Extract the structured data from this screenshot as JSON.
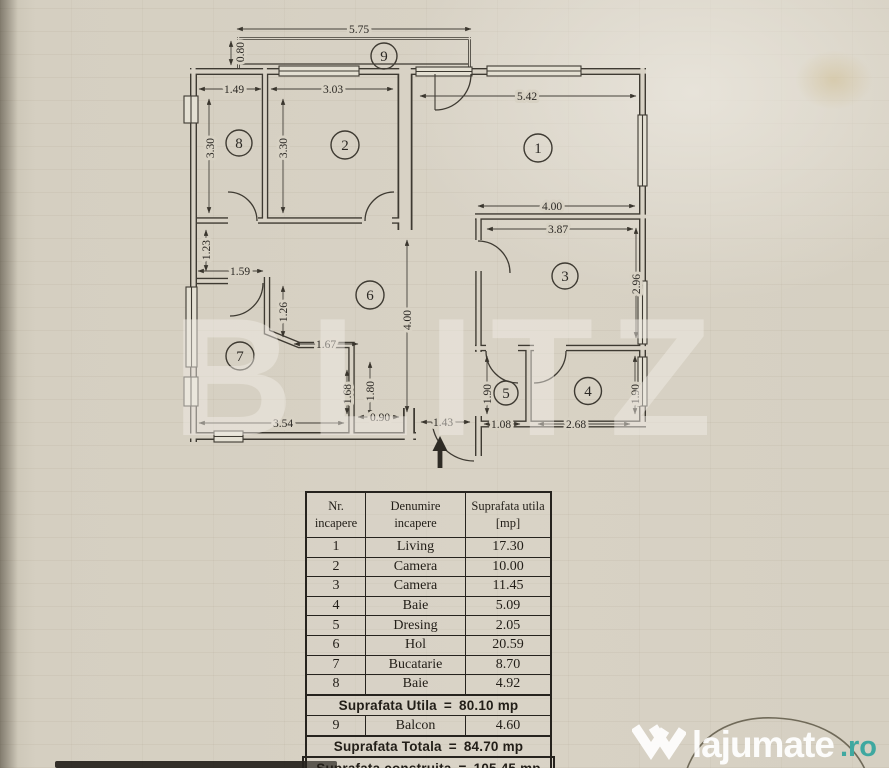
{
  "paper": {
    "color": "#d7d1c3"
  },
  "watermark": {
    "text": "BLITZ"
  },
  "brand": {
    "name": "lajumate",
    "tld": ".ro",
    "icon": "double-chevron-w-icon"
  },
  "floorplan": {
    "rooms": [
      "1",
      "2",
      "3",
      "4",
      "5",
      "6",
      "7",
      "8",
      "9"
    ],
    "dims": [
      "5.75",
      "0.80",
      "1.49",
      "3.03",
      "5.42",
      "3.30",
      "3.30",
      "4.00",
      "3.87",
      "2.96",
      "1.23",
      "1.59",
      "1.26",
      "1.67",
      "4.00",
      "1.68",
      "1.80",
      "3.54",
      "0.90",
      "1.43",
      "1.90",
      "1.08",
      "2.68",
      "1.90"
    ],
    "entrance_direction": "up"
  },
  "table": {
    "header": {
      "col1_line1": "Nr.",
      "col1_line2": "incapere",
      "col2_line1": "Denumire",
      "col2_line2": "incapere",
      "col3_line1": "Suprafata utila",
      "col3_line2": "[mp]"
    },
    "rows": [
      {
        "nr": "1",
        "name": "Living",
        "area": "17.30"
      },
      {
        "nr": "2",
        "name": "Camera",
        "area": "10.00"
      },
      {
        "nr": "3",
        "name": "Camera",
        "area": "11.45"
      },
      {
        "nr": "4",
        "name": "Baie",
        "area": "5.09"
      },
      {
        "nr": "5",
        "name": "Dresing",
        "area": "2.05"
      },
      {
        "nr": "6",
        "name": "Hol",
        "area": "20.59"
      },
      {
        "nr": "7",
        "name": "Bucatarie",
        "area": "8.70"
      },
      {
        "nr": "8",
        "name": "Baie",
        "area": "4.92"
      }
    ],
    "summary_utila": {
      "label": "Suprafata Utila",
      "equals": "=",
      "value": "80.10 mp"
    },
    "balcon": {
      "nr": "9",
      "name": "Balcon",
      "area": "4.60"
    },
    "summary_totala": {
      "label": "Suprafata Totala",
      "equals": "=",
      "value": "84.70 mp"
    },
    "summary_construita": {
      "label": "Suprafata construita",
      "equals": "=",
      "value": "105.45 mp"
    }
  }
}
